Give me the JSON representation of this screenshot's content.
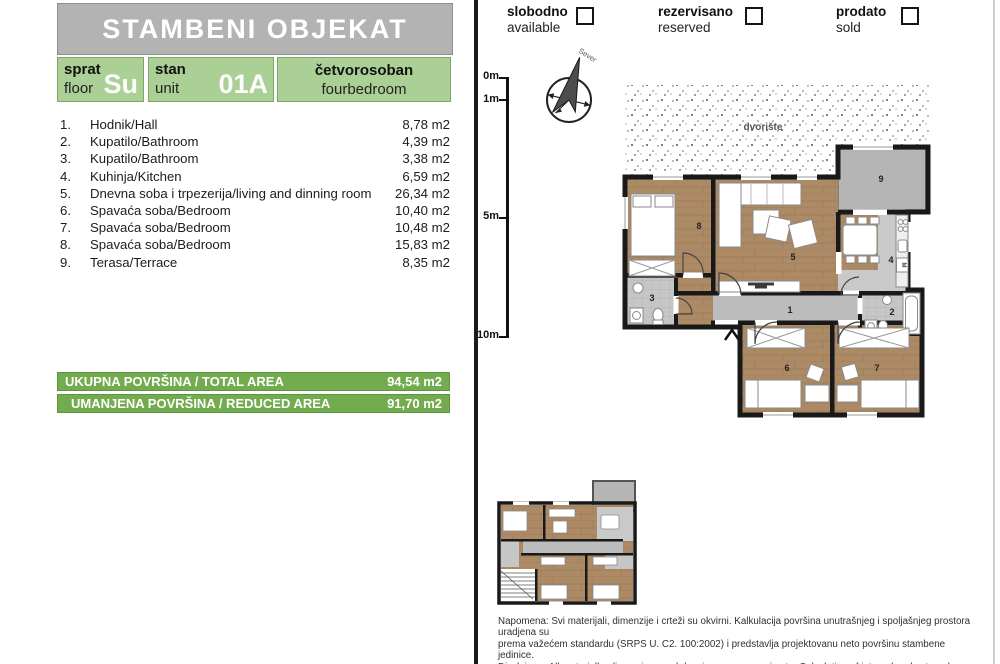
{
  "colors": {
    "accent_green": "#72ac4e",
    "light_green": "#aad096",
    "header_gray": "#b3b3b3",
    "wall_black": "#191919",
    "wood_floor": "#ac8a66",
    "tile_gray": "#c6c6c6"
  },
  "header": {
    "title": "STAMBENI OBJEKAT"
  },
  "info": {
    "floor_label_sr": "sprat",
    "floor_label_en": "floor",
    "floor_value": "Su",
    "unit_label_sr": "stan",
    "unit_label_en": "unit",
    "unit_value": "01A",
    "type_sr": "četvorosoban",
    "type_en": "fourbedroom"
  },
  "rooms": [
    {
      "num": "1.",
      "name": "Hodnik/Hall",
      "area": "8,78 m2"
    },
    {
      "num": "2.",
      "name": "Kupatilo/Bathroom",
      "area": "4,39 m2"
    },
    {
      "num": "3.",
      "name": "Kupatilo/Bathroom",
      "area": "3,38 m2"
    },
    {
      "num": "4.",
      "name": "Kuhinja/Kitchen",
      "area": "6,59 m2"
    },
    {
      "num": "5.",
      "name": "Dnevna soba i trpezerija/living and dinning room",
      "area": "26,34 m2"
    },
    {
      "num": "6.",
      "name": "Spavaća soba/Bedroom",
      "area": "10,40 m2"
    },
    {
      "num": "7.",
      "name": "Spavaća soba/Bedroom",
      "area": "10,48 m2"
    },
    {
      "num": "8.",
      "name": "Spavaća soba/Bedroom",
      "area": "15,83 m2"
    },
    {
      "num": "9.",
      "name": "Terasa/Terrace",
      "area": "8,35 m2"
    }
  ],
  "totals": {
    "total": {
      "label": "UKUPNA POVRŠINA / TOTAL AREA",
      "value": "94,54 m2"
    },
    "reduced": {
      "label": "UMANJENA POVRŠINA / REDUCED AREA",
      "value": "91,70 m2"
    }
  },
  "legend": {
    "available": {
      "sr": "slobodno",
      "en": "available"
    },
    "reserved": {
      "sr": "rezervisano",
      "en": "reserved"
    },
    "sold": {
      "sr": "prodato",
      "en": "sold"
    }
  },
  "scale": {
    "t0": "0m",
    "t1": "1m",
    "t5": "5m",
    "t10": "10m"
  },
  "compass": {
    "north": "Sever"
  },
  "plan": {
    "courtyard": "dvorište",
    "washer": "M",
    "numbers": {
      "hallway": "1",
      "bathroom_main": "2",
      "bathroom_small": "3",
      "kitchen": "4",
      "living": "5",
      "bedroom_a": "6",
      "bedroom_b": "7",
      "bedroom_c": "8",
      "terrace": "9"
    }
  },
  "disclaimer": {
    "line1": "Napomena: Svi materijali, dimenzije i crteži su okvirni. Kalkulacija površina unutrašnjeg i spoljašnjeg prostora uradjena su",
    "line2": "prema važećem standardu (SRPS U. C2. 100:2002) i predstavlja projektovanu neto površinu stambene jedinice.",
    "line3": "Disclaimer: All materialls, dimensions and drawings are approximate. Calculation of internal and external area is fully",
    "line4": "compliant with local standards (SRPS U. C2. 100:2002) and as such it represent the net area of the unit."
  }
}
